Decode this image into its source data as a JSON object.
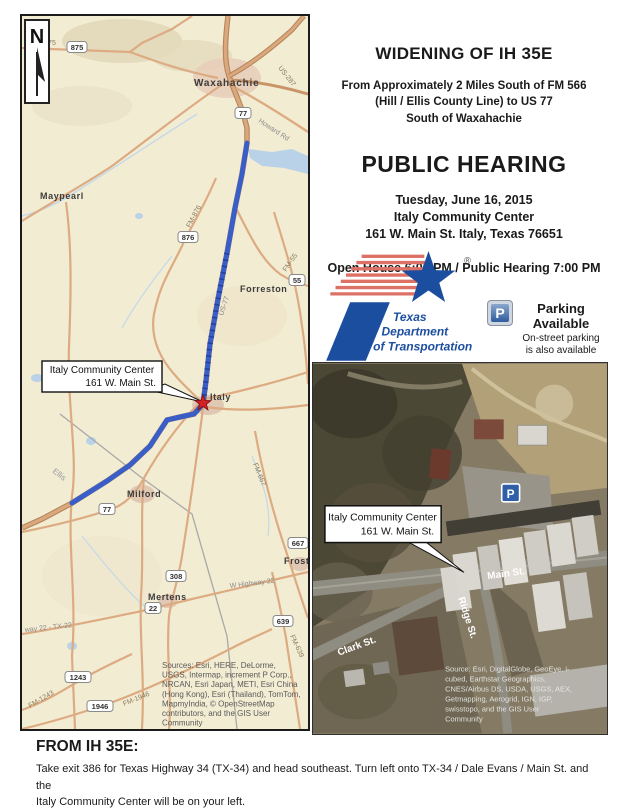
{
  "header": {
    "title": "WIDENING OF IH 35E",
    "subtitle_lines": [
      "From Approximately 2 Miles South of FM 566",
      "(Hill / Ellis County Line) to US 77",
      "South of Waxahachie"
    ],
    "hearing_title": "PUBLIC HEARING",
    "date": "Tuesday, June 16, 2015",
    "venue": "Italy Community Center",
    "address": "161 W. Main St. Italy, Texas 76651",
    "times": "Open House 6:00 PM / Public Hearing 7:00 PM"
  },
  "logo": {
    "org_line1": "Texas",
    "org_line2": "Department",
    "org_line3": "of Transportation",
    "registered": "®"
  },
  "parking": {
    "icon_letter": "P",
    "title_line1": "Parking",
    "title_line2": "Available",
    "note_line1": "On-street parking",
    "note_line2": "is also available"
  },
  "colors": {
    "route_blue": "#3a5ec8",
    "logo_blue": "#1c4ea0",
    "logo_red": "#dd7166",
    "star_red": "#d42027",
    "parking_blue": "#2f5d9e"
  },
  "map": {
    "north_label": "N",
    "towns": [
      "Waxahachie",
      "Maypearl",
      "Forreston",
      "Italy",
      "Milford",
      "Mertens",
      "Frost"
    ],
    "county_label": "Ellis",
    "road_labels": [
      "M-875",
      "US-287",
      "Howard Rd",
      "FM-876",
      "US-77",
      "FM-55",
      "FM-667",
      "W Highway 22",
      "way 22 - TX-22",
      "FM-639",
      "FM-1243",
      "FM-1946"
    ],
    "shields": [
      "875",
      "77",
      "876",
      "55",
      "77",
      "667",
      "308",
      "22",
      "639",
      "1243",
      "1946"
    ],
    "callout": {
      "line1": "Italy Community Center",
      "line2": "161 W. Main St."
    },
    "sources_lines": [
      "Sources: Esri, HERE, DeLorme,",
      "USGS, Intermap, increment P Corp.,",
      "NRCAN, Esri Japan, METI, Esri China",
      "(Hong Kong), Esri (Thailand), TomTom,",
      "MapmyIndia, © OpenStreetMap",
      "contributors, and the GIS User",
      "Community"
    ]
  },
  "aerial": {
    "streets": [
      "Main St.",
      "Clark St.",
      "Ridge St."
    ],
    "parking_letter": "P",
    "callout": {
      "line1": "Italy Community Center",
      "line2": "161 W. Main St."
    },
    "source_lines": [
      "Source: Esri, DigitalGlobe, GeoEye, i-",
      "cubed, Earthstar Geographics,",
      "CNES/Airbus DS, USDA, USGS, AEX,",
      "Getmapping, Aerogrid, IGN, IGP,",
      "swisstopo, and the GIS User",
      "Community"
    ]
  },
  "directions": {
    "heading": "FROM IH 35E:",
    "lines": [
      "Take exit  386 for Texas Highway 34 (TX-34) and head southeast.  Turn left onto TX-34 / Dale Evans / Main St. and the",
      "Italy Community Center will be on your left."
    ]
  }
}
